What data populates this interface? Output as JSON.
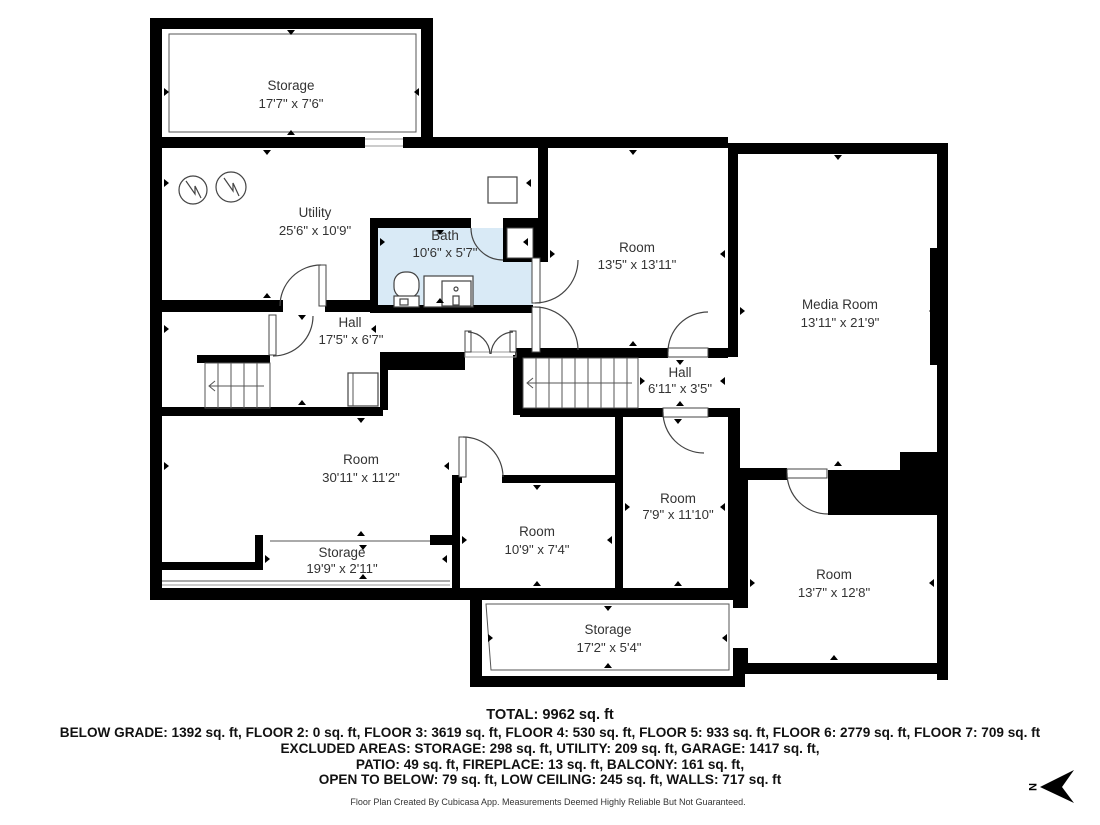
{
  "plan": {
    "rooms": [
      {
        "name": "Storage",
        "dims": "17'7\" x 7'6\""
      },
      {
        "name": "Utility",
        "dims": "25'6\" x 10'9\""
      },
      {
        "name": "Bath",
        "dims": "10'6\" x 5'7\""
      },
      {
        "name": "Room",
        "dims": "13'5\" x 13'11\""
      },
      {
        "name": "Media Room",
        "dims": "13'11\" x 21'9\""
      },
      {
        "name": "Hall",
        "dims": "17'5\" x 6'7\""
      },
      {
        "name": "Hall",
        "dims": "6'11\" x 3'5\""
      },
      {
        "name": "Room",
        "dims": "30'11\" x 11'2\""
      },
      {
        "name": "Storage",
        "dims": "19'9\" x 2'11\""
      },
      {
        "name": "Room",
        "dims": "10'9\" x 7'4\""
      },
      {
        "name": "Room",
        "dims": "7'9\" x 11'10\""
      },
      {
        "name": "Room",
        "dims": "13'7\" x 12'8\""
      },
      {
        "name": "Storage",
        "dims": "17'2\" x 5'4\""
      }
    ],
    "compass_label": "N"
  },
  "summary": {
    "total": "TOTAL: 9962 sq. ft",
    "line1": "BELOW GRADE: 1392 sq. ft, FLOOR 2: 0 sq. ft, FLOOR 3: 3619 sq. ft, FLOOR 4: 530 sq. ft, FLOOR 5: 933 sq. ft, FLOOR 6: 2779 sq. ft, FLOOR 7: 709 sq. ft",
    "line2": "EXCLUDED AREAS: STORAGE: 298 sq. ft, UTILITY: 209 sq. ft, GARAGE: 1417 sq. ft,",
    "line3": "PATIO: 49 sq. ft, FIREPLACE: 13 sq. ft, BALCONY: 161 sq. ft,",
    "line4": "OPEN TO BELOW: 79 sq. ft, LOW CEILING: 245 sq. ft, WALLS: 717 sq. ft"
  },
  "footer": "Floor Plan Created By Cubicasa App. Measurements Deemed Highly Reliable But Not Guaranteed.",
  "colors": {
    "wall": "#000000",
    "bath_fill": "#d9eaf6",
    "label_text": "#333333"
  }
}
